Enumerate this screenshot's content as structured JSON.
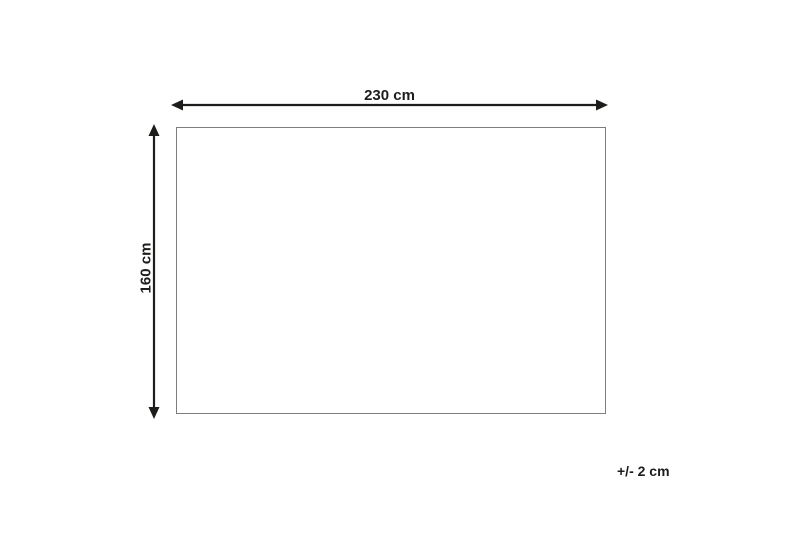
{
  "diagram": {
    "type": "product-dimension-diagram",
    "width_label": "230 cm",
    "height_label": "160 cm",
    "tolerance_label": "+/- 2 cm",
    "shape": "rectangle",
    "colors": {
      "background": "#ffffff",
      "arrow": "#1d1d1b",
      "outline": "#7d7d7d",
      "text": "#1d1d1b"
    }
  }
}
